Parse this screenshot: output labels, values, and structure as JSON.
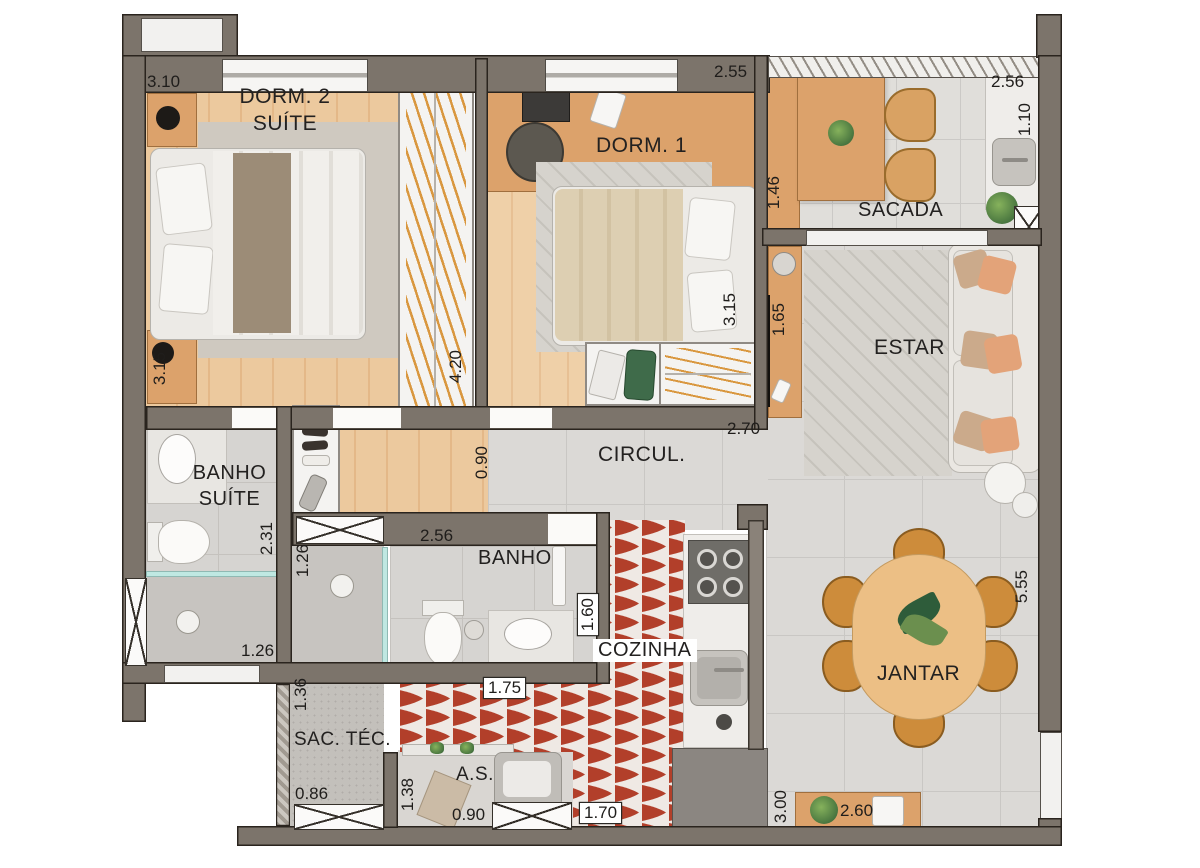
{
  "plan_title": "apartment-floor-plan",
  "rooms": {
    "dorm2": {
      "line1": "DORM. 2",
      "line2": "SUÍTE"
    },
    "dorm1": {
      "label": "DORM. 1"
    },
    "sacada": {
      "label": "SACADA"
    },
    "estar": {
      "label": "ESTAR"
    },
    "circul": {
      "label": "CIRCUL."
    },
    "banho_suite": {
      "line1": "BANHO",
      "line2": "SUÍTE"
    },
    "banho": {
      "label": "BANHO"
    },
    "cozinha": {
      "label": "COZINHA"
    },
    "jantar": {
      "label": "JANTAR"
    },
    "sac_tec": {
      "label": "SAC. TÉC."
    },
    "as": {
      "label": "A.S."
    }
  },
  "dims": {
    "dorm2_width": "3.10",
    "dorm2_depth": "3.15",
    "dorm1_width": "2.55",
    "dorm1_depth": "3.15",
    "closet_depth": "4.20",
    "hall_width": "0.90",
    "sacada_counter_width": "2.56",
    "sacada_sink_depth": "1.10",
    "sacada_cabinet_depth": "1.46",
    "estar_rack_depth": "1.65",
    "circul_width": "2.70",
    "banho_suite_depth": "2.31",
    "banho_suite_width": "1.26",
    "banho_shower_width": "1.26",
    "banho_width": "2.56",
    "cozinha_width": "1.60",
    "cozinha_passage": "1.75",
    "cozinha_bottom": "1.70",
    "jantar_depth": "5.55",
    "jantar_bottom_depth": "3.00",
    "sideboard_width": "2.60",
    "sac_tec_depth": "1.36",
    "sac_tec_width": "0.86",
    "as_depth": "1.38",
    "as_width": "0.90"
  },
  "palette": {
    "wall": "#7c746b",
    "wood_floor": "#e9c296",
    "furniture_wood": "#dca26b",
    "gray_tile": "#dbd9d6",
    "kitchen_tile_red": "#b23f2a",
    "pillow_accent": "#e3a379",
    "glass_teal": "#bfe8e2"
  }
}
